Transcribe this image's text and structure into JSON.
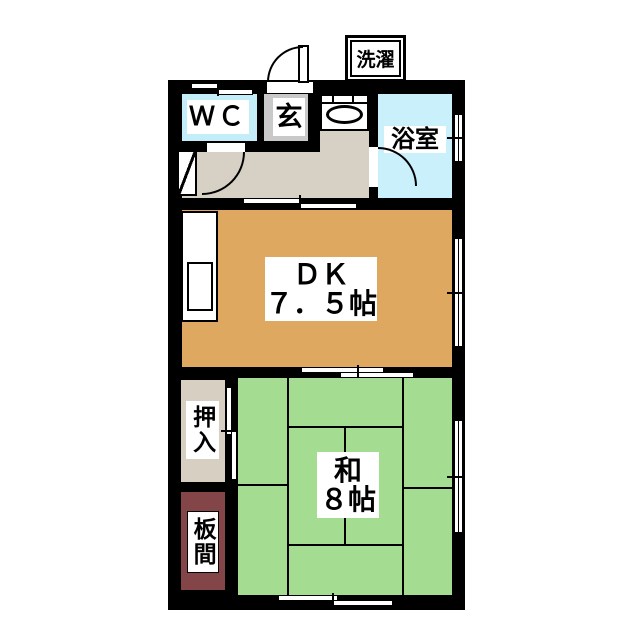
{
  "floorplan": {
    "annotations": {
      "laundry": "洗濯"
    },
    "rooms": {
      "wc": {
        "label": "ＷＣ"
      },
      "entrance": {
        "label": "玄"
      },
      "bathroom": {
        "label": "浴室"
      },
      "dining_kitchen": {
        "label": "ＤＫ",
        "size": "７．５帖"
      },
      "japanese_room": {
        "label": "和",
        "size": "８帖"
      },
      "closet": {
        "label": "押入"
      },
      "wood_floor": {
        "label": "板間"
      }
    },
    "colors": {
      "wall": "#000000",
      "wc_fill": "#c3edf9",
      "bathroom_fill": "#c9f0fb",
      "entrance_fill": "#c9c9c9",
      "hallway_fill": "#d6d1c4",
      "dining_kitchen_fill": "#dfa860",
      "tatami_fill": "#a4dc91",
      "closet_fill": "#d6cfc2",
      "wood_floor_fill": "#834547",
      "label_background": "#ffffff"
    }
  }
}
